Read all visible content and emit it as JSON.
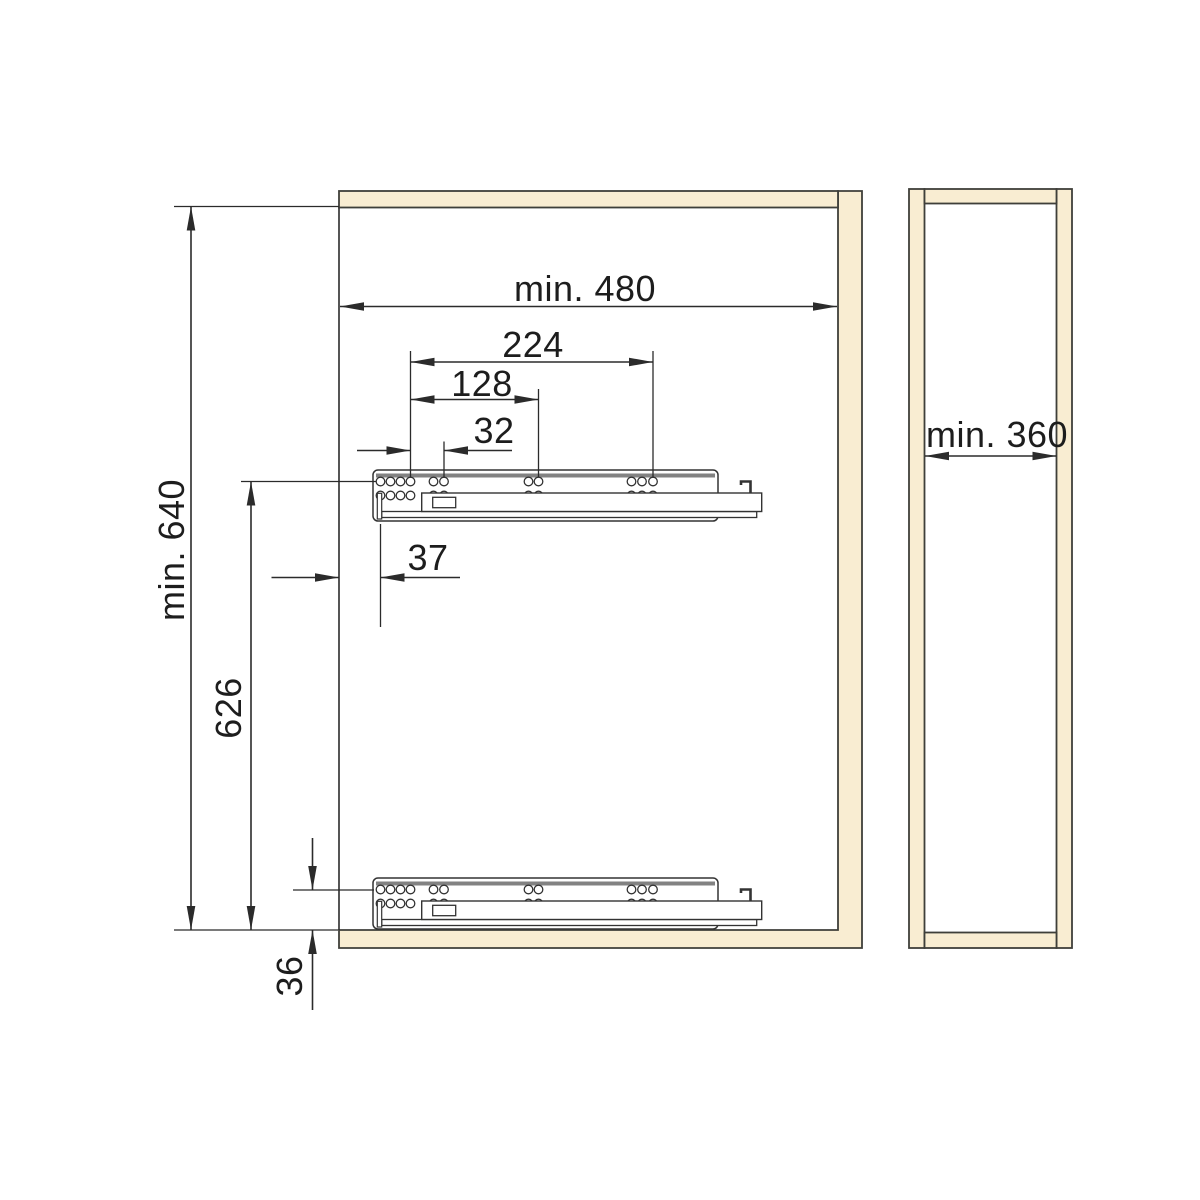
{
  "colors": {
    "panel_fill": "#F9EDD2",
    "panel_stroke": "#3F3F3A",
    "line": "#2B2B2B",
    "rail_accent": "#828282",
    "background": "#FFFFFF"
  },
  "front_view": {
    "dim_width": "min. 480",
    "dim_height": "min. 640",
    "dim_hole_span_outer": "224",
    "dim_hole_span_mid": "128",
    "dim_hole_span_inner": "32",
    "dim_front_setback": "37",
    "dim_rail_spacing": "626",
    "dim_bottom_offset": "36"
  },
  "side_view": {
    "dim_depth": "min. 360"
  }
}
